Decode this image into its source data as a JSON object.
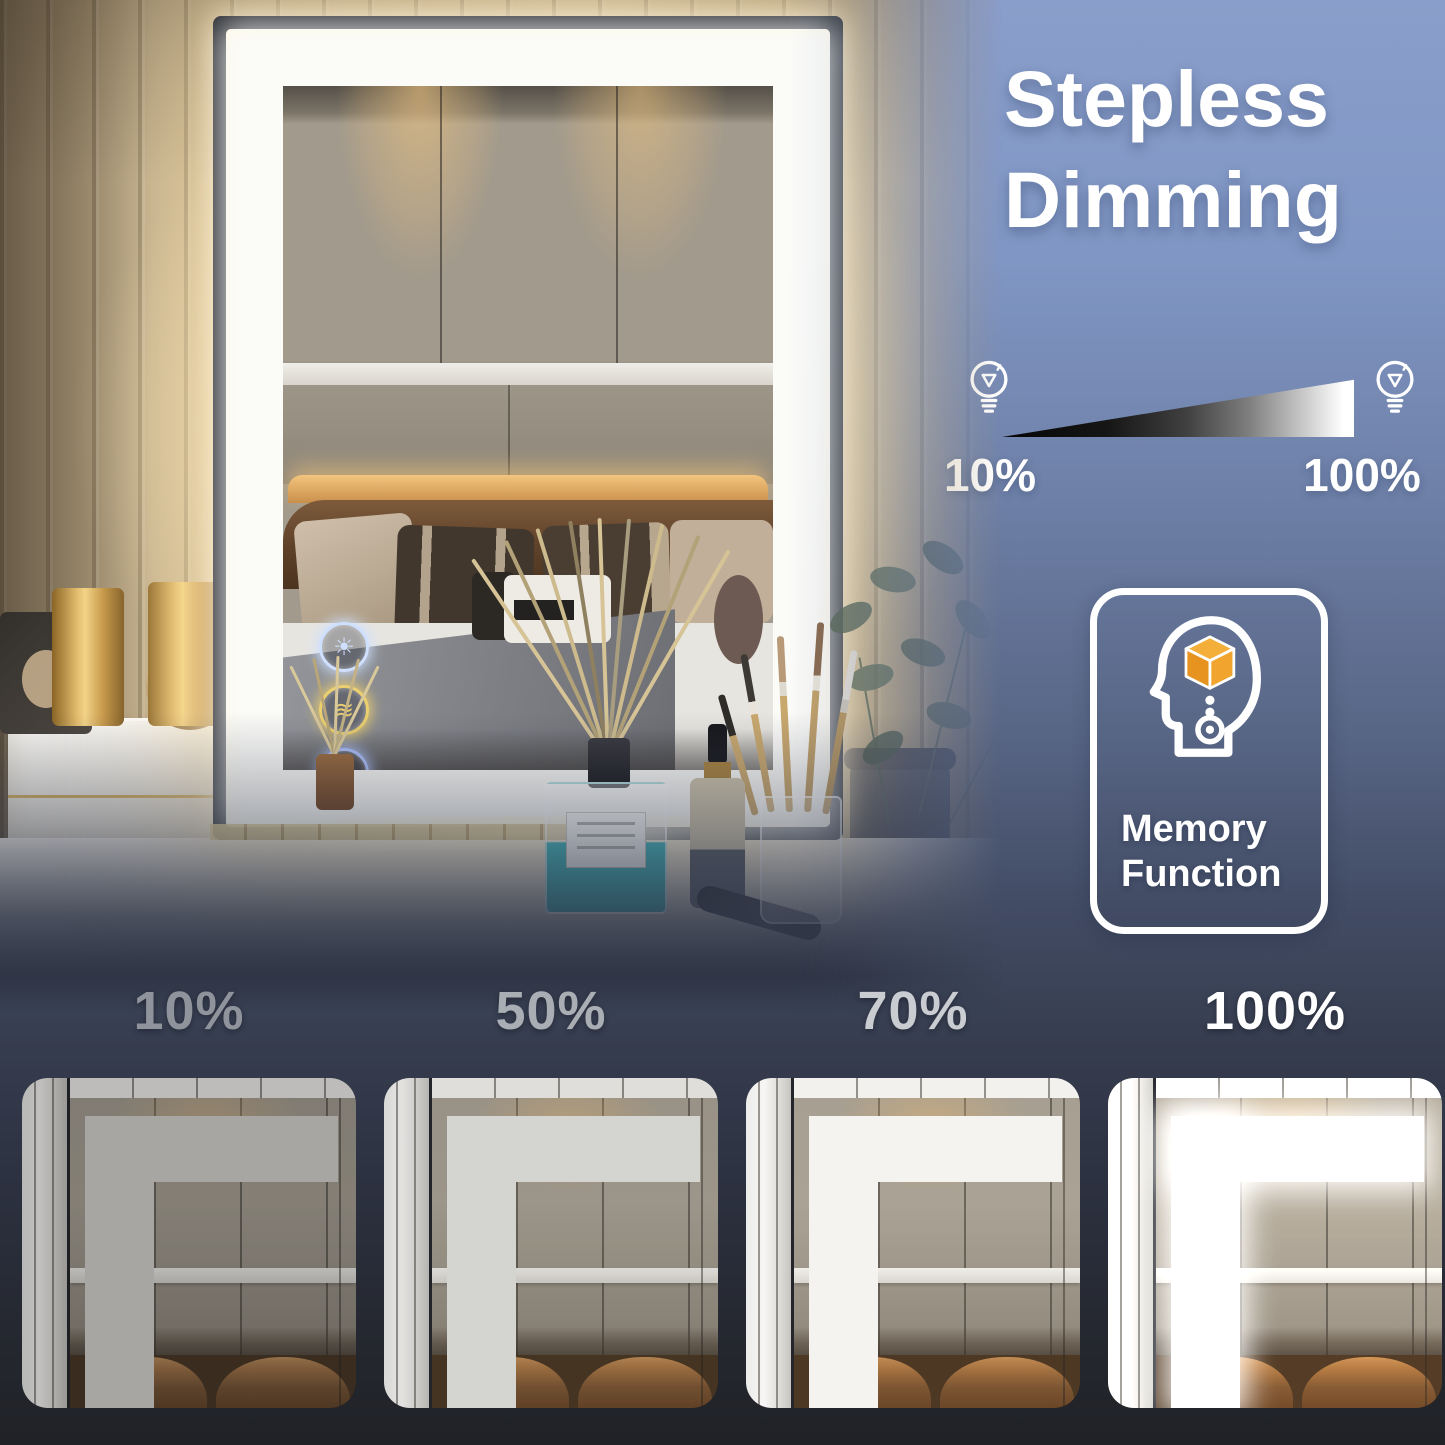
{
  "feature": {
    "title_line1": "Stepless",
    "title_line2": "Dimming",
    "dimmer": {
      "min_label": "10%",
      "max_label": "100%",
      "min_icon": "bulb-icon",
      "max_icon": "bulb-icon"
    },
    "memory_card": {
      "line1": "Memory",
      "line2": "Function",
      "icon": "memory-head-icon",
      "cube_color": "#f2a93b"
    }
  },
  "hero_photo": {
    "touch_buttons": [
      {
        "name": "daylight-mode",
        "glyph": "☀",
        "color": "#cfe0ff"
      },
      {
        "name": "warm-light-mode",
        "glyph": "≋",
        "color": "#eccf6e"
      },
      {
        "name": "cool-light-mode",
        "glyph": "☼",
        "color": "#a9bdf7"
      }
    ],
    "tube_label": "155",
    "jar_label": "LA BRUKET"
  },
  "brightness_levels": [
    {
      "label": "10%",
      "label_color": "#8f939b",
      "led_color": "#d6d5d1",
      "filter": "brightness(0.78) saturate(0.85)"
    },
    {
      "label": "50%",
      "label_color": "#a9adb4",
      "led_color": "#e7e6e2",
      "filter": "brightness(0.92) saturate(0.95)"
    },
    {
      "label": "70%",
      "label_color": "#c9ccd1",
      "led_color": "#f4f3ef",
      "filter": "brightness(1.0)"
    },
    {
      "label": "100%",
      "label_color": "#ffffff",
      "led_color": "#ffffff",
      "filter": "brightness(1.08) saturate(1.05)"
    }
  ],
  "colors": {
    "bg_top": "#8a9ecb",
    "bg_bottom": "#202227",
    "led_white": "#ffffff",
    "accent_cube": "#f2a93b"
  }
}
